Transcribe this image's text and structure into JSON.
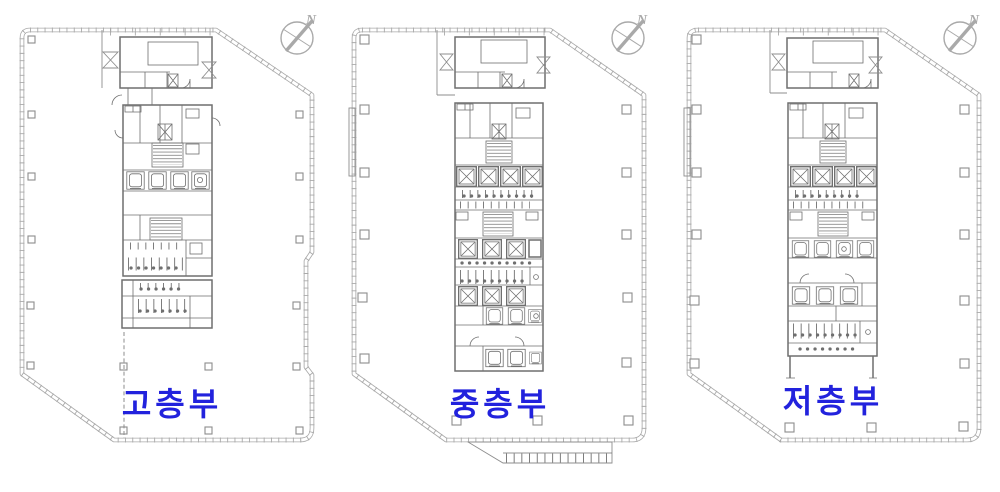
{
  "colors": {
    "accent-blue": "#2222dd",
    "line-light": "#a9a9a9",
    "line-mid": "#8d8d8d",
    "line-dark": "#6f6f6f"
  },
  "plans": [
    {
      "id": "high",
      "label": "고층부",
      "compass_label": "N"
    },
    {
      "id": "mid",
      "label": "중층부",
      "compass_label": "N"
    },
    {
      "id": "low",
      "label": "저층부",
      "compass_label": "N"
    }
  ]
}
